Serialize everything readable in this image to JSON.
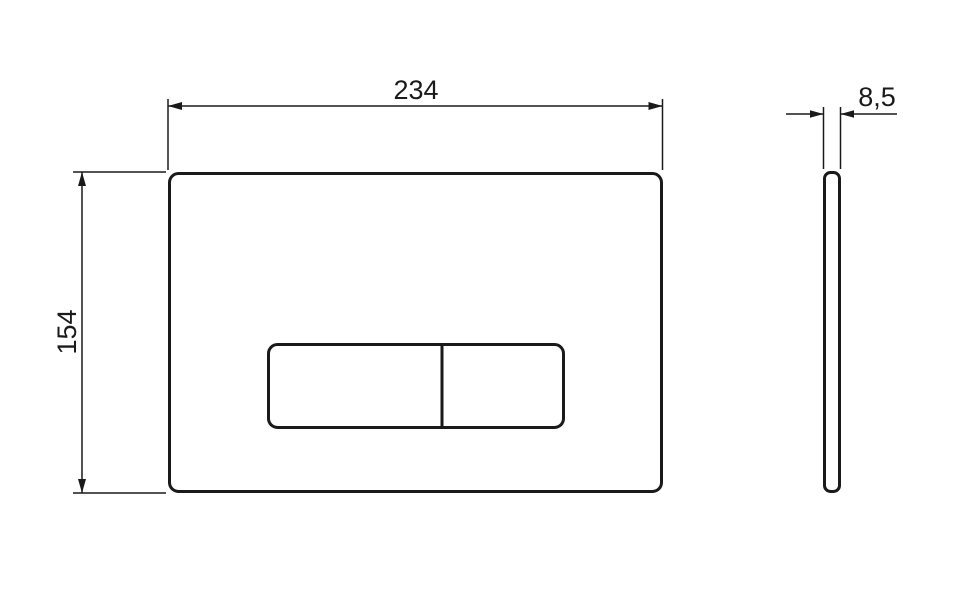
{
  "drawing": {
    "type": "technical-dimension-drawing",
    "subject": "flush-plate",
    "colors": {
      "line": "#1a1a1a",
      "background": "#ffffff"
    },
    "front_view": {
      "width_label": "234",
      "height_label": "154"
    },
    "side_view": {
      "thickness_label": "8,5"
    }
  }
}
